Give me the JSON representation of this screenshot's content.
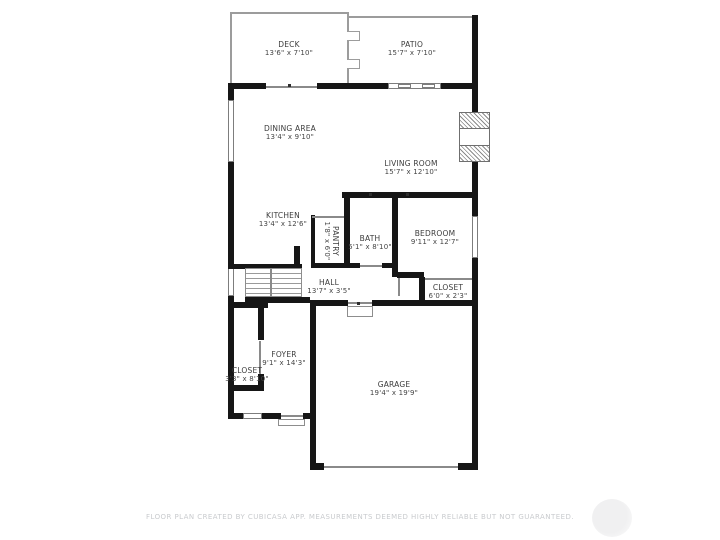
{
  "meta": {
    "footer": "FLOOR PLAN CREATED BY CUBICASA APP. MEASUREMENTS DEEMED HIGHLY RELIABLE BUT NOT GUARANTEED."
  },
  "colors": {
    "wall": "#161616",
    "thin_line": "#8a8a8a",
    "label_text": "#3c3c3c",
    "footer_text": "#c9cbce",
    "background": "#ffffff"
  },
  "rooms": [
    {
      "id": "deck",
      "name": "DECK",
      "dims": "13'6\" x 7'10\""
    },
    {
      "id": "patio",
      "name": "PATIO",
      "dims": "15'7\" x 7'10\""
    },
    {
      "id": "dining-area",
      "name": "DINING AREA",
      "dims": "13'4\" x 9'10\""
    },
    {
      "id": "living-room",
      "name": "LIVING ROOM",
      "dims": "15'7\" x 12'10\""
    },
    {
      "id": "kitchen",
      "name": "KITCHEN",
      "dims": "13'4\" x 12'6\""
    },
    {
      "id": "pantry",
      "name": "PANTRY",
      "dims": "1'8\" x 6'0\""
    },
    {
      "id": "bath",
      "name": "BATH",
      "dims": "5'1\" x 8'10\""
    },
    {
      "id": "bedroom",
      "name": "BEDROOM",
      "dims": "9'11\" x 12'7\""
    },
    {
      "id": "hall",
      "name": "HALL",
      "dims": "13'7\" x 3'5\""
    },
    {
      "id": "closet-bedroom",
      "name": "CLOSET",
      "dims": "6'0\" x 2'3\""
    },
    {
      "id": "foyer",
      "name": "FOYER",
      "dims": "9'1\" x 14'3\""
    },
    {
      "id": "closet-foyer",
      "name": "CLOSET",
      "dims": "3'3\" x 8'10\""
    },
    {
      "id": "garage",
      "name": "GARAGE",
      "dims": "19'4\" x 19'9\""
    }
  ]
}
